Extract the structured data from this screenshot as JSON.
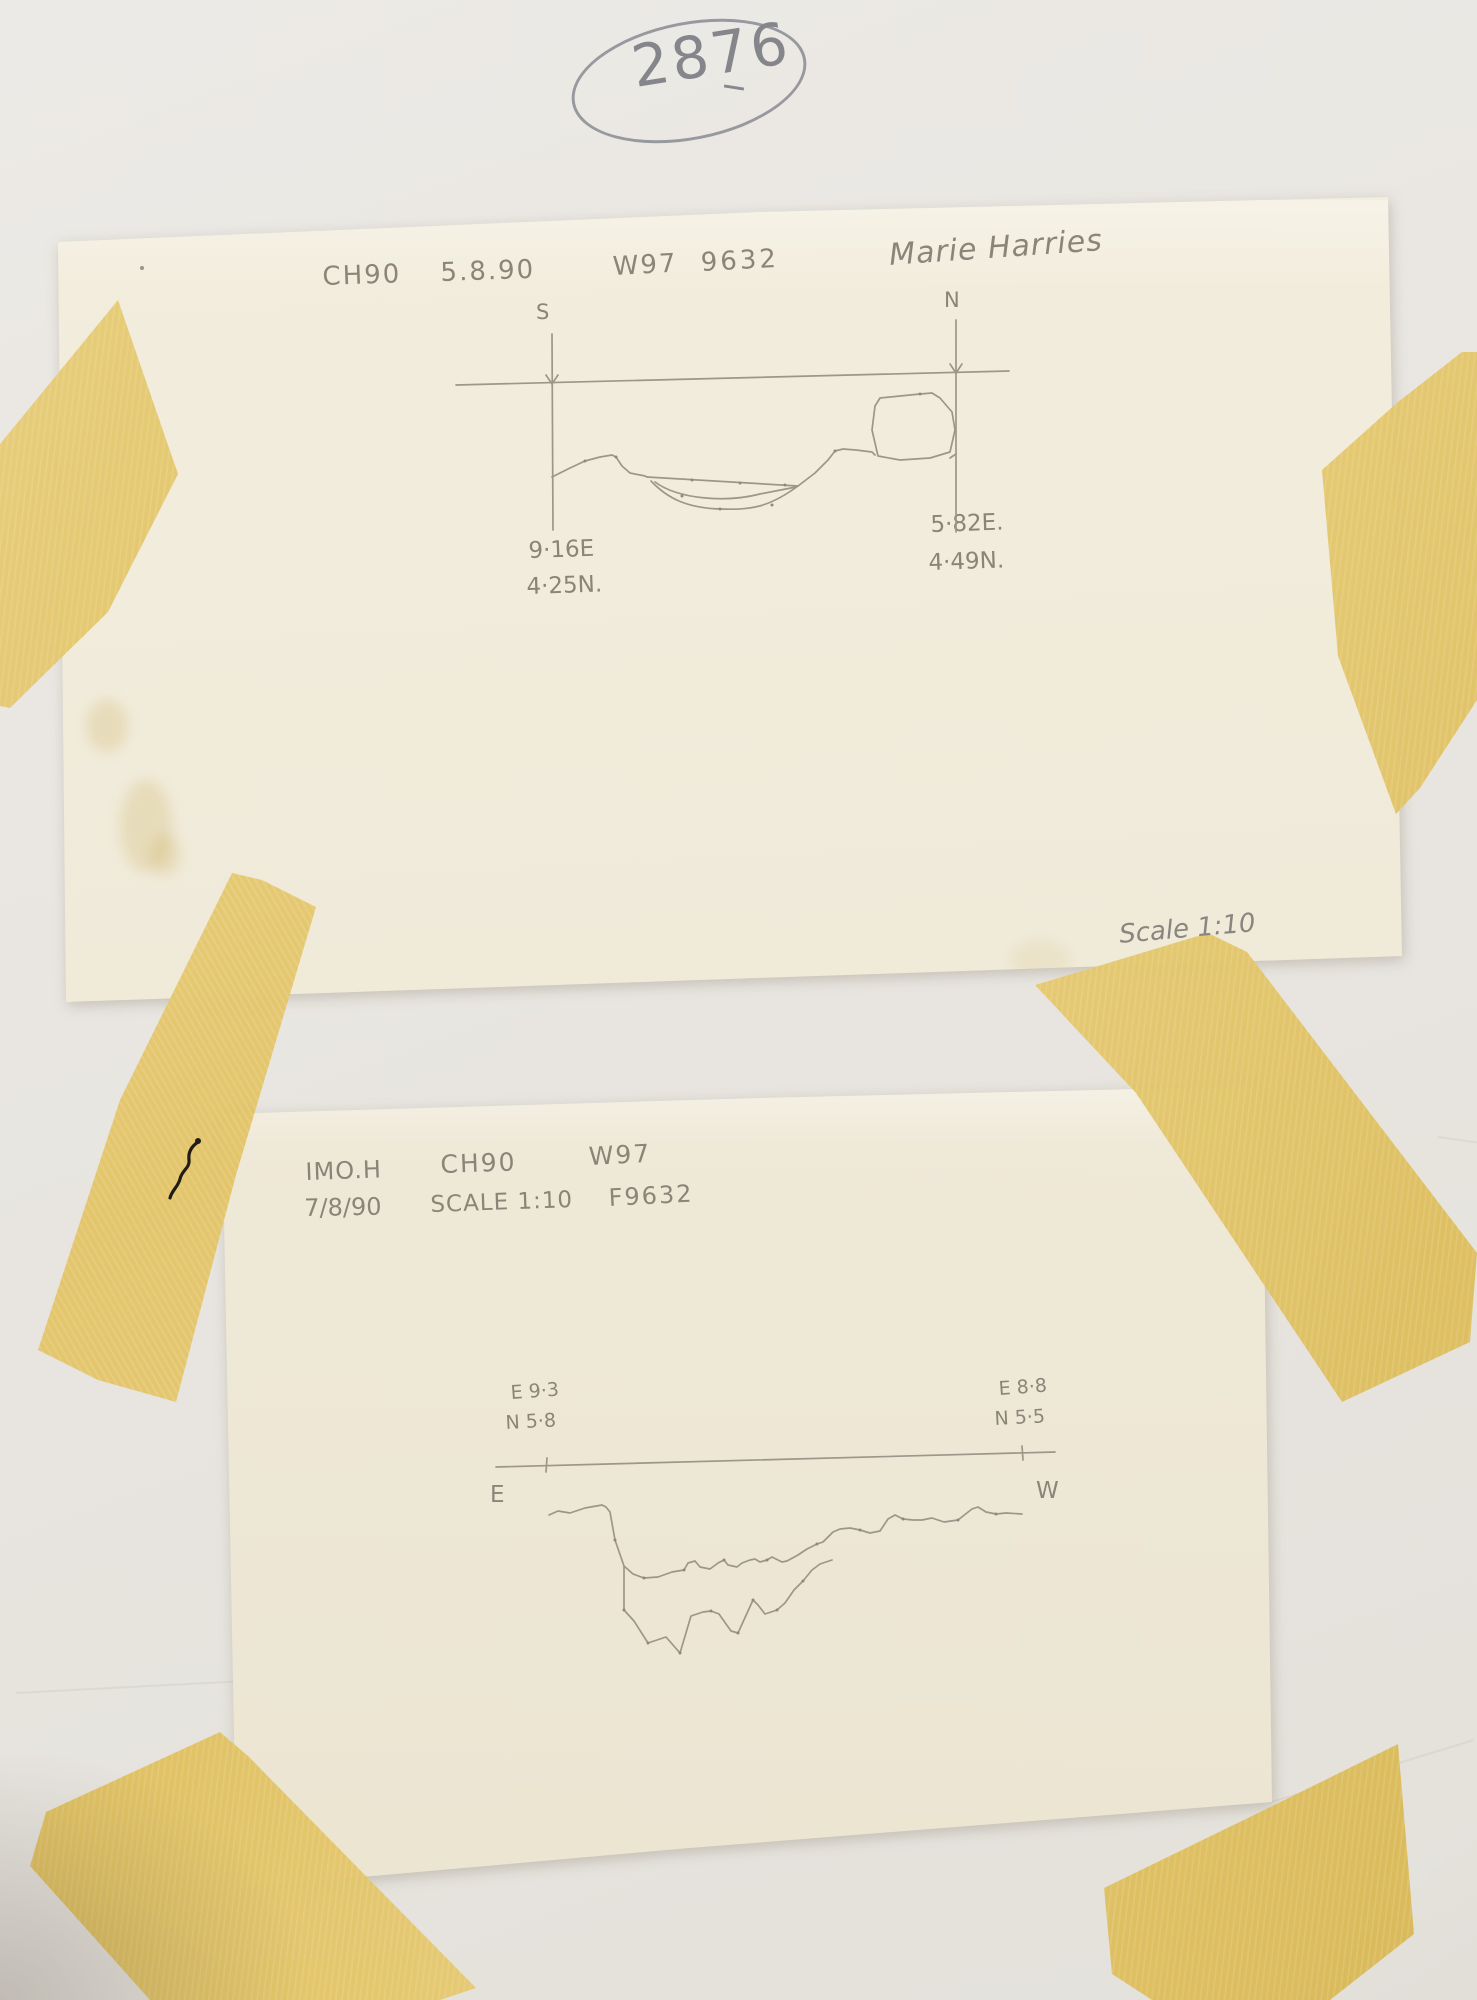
{
  "photo": {
    "catalog_number": "2876",
    "sheet1": {
      "header": {
        "site_code": "CH90",
        "date": "5.8.90",
        "trench": "W97",
        "find_no": "9632",
        "recorder": "Marie Harries"
      },
      "section": {
        "left_end_label": "S",
        "right_end_label": "N",
        "left_coords": [
          "9·16E",
          "4·25N."
        ],
        "right_coords": [
          "5·82E.",
          "4·49N."
        ]
      },
      "scale_note": "Scale 1:10"
    },
    "sheet2": {
      "header_row1": [
        "IMO.H",
        "CH90",
        "W97"
      ],
      "header_row2": [
        "7/8/90",
        "SCALE 1:10",
        "F9632"
      ],
      "section": {
        "left_end_label": "E",
        "right_end_label": "W",
        "left_coords": [
          "E 9·3",
          "N 5·8"
        ],
        "right_coords": [
          "E 8·8",
          "N 5·5"
        ]
      }
    },
    "colors": {
      "tape": "#e0c266",
      "tracing_paper": "#efe9d8",
      "backing_paper": "#e9e6e1",
      "pencil": "#8b8478"
    }
  }
}
